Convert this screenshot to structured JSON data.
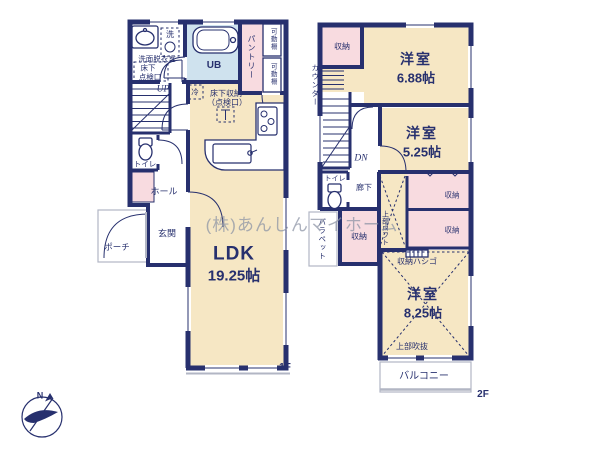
{
  "watermark": "(株)あんしんマイホーム",
  "compass": {
    "north_label": "N"
  },
  "colors": {
    "wall": "#27306e",
    "cream": "#f6e7c4",
    "pink": "#f8dbe0",
    "bath": "#cfe2ee",
    "gray": "#b2b6c4",
    "text": "#27306e",
    "watermark": "#8b93a5"
  },
  "floor1": {
    "floor_label": "1F",
    "washroom_line1": "洗面脱衣室",
    "washroom_line2": "床下",
    "washroom_line3": "点検口",
    "laundry": "洗",
    "bath": "UB",
    "pantry": "パントリー",
    "shelf_top": "可動棚",
    "shelf_bottom": "可動棚",
    "stairs_up": "UP",
    "toilet": "トイレ",
    "hall": "ホール",
    "entrance": "玄関",
    "porch": "ポーチ",
    "fridge": "冷",
    "underfloor_line1": "床下収納",
    "underfloor_line2": "（点検口）",
    "ldk_name": "LDK",
    "ldk_size": "19.25帖"
  },
  "floor2": {
    "floor_label": "2F",
    "counter": "カウンター",
    "closet_nw": "収納",
    "room1_name": "洋室",
    "room1_size": "6.88帖",
    "stairs_down": "DN",
    "room2_name": "洋室",
    "room2_size": "5.25帖",
    "toilet": "トイレ",
    "hallway": "廊下",
    "parapet": "パラペット",
    "closet_loft": "収納",
    "loft_above": "上部ロフト",
    "closet_right1": "収納",
    "closet_right2": "収納",
    "ladder": "収納ハシゴ",
    "room3_name": "洋室",
    "room3_size": "8.25帖",
    "void_above": "上部吹抜",
    "balcony": "バルコニー"
  }
}
